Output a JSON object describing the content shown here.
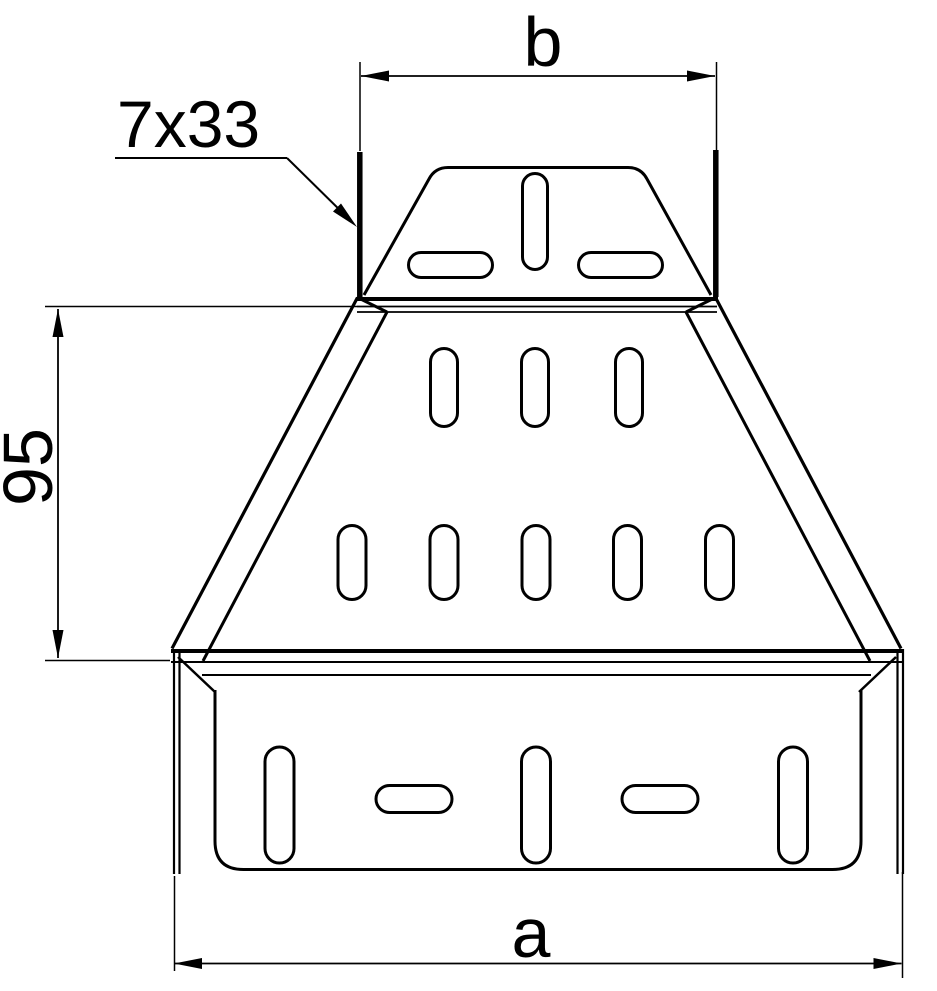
{
  "drawing": {
    "type": "technical-dimension-drawing",
    "subject": "cable-tray symmetrical reducer, top view",
    "background_color": "#ffffff",
    "line_color": "#000000",
    "labels": {
      "top_width": "b",
      "bottom_width": "a",
      "side_height": "95",
      "slot_callout": "7x33"
    }
  }
}
